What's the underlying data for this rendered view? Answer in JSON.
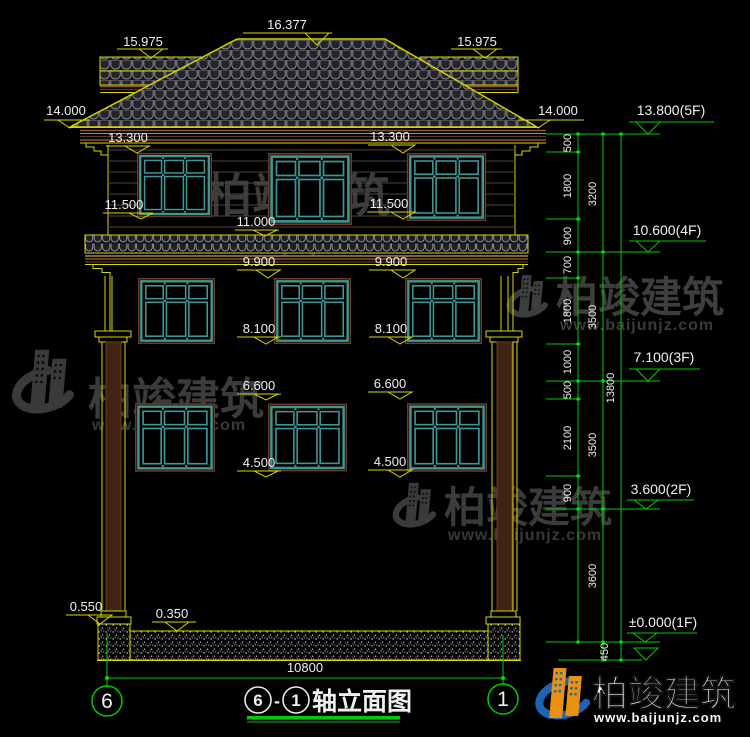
{
  "watermark": {
    "brand": "柏竣建筑",
    "url": "www.baijunjz.com"
  },
  "title": {
    "axis_from": "6",
    "dash": "-",
    "axis_to": "1",
    "name": "轴立面图"
  },
  "axis_bubbles": {
    "left": "6",
    "right": "1"
  },
  "bottom_dim": {
    "total_width": "10800"
  },
  "levels": {
    "ridge": "16.377",
    "wing_left": "15.975",
    "wing_right": "15.975",
    "eave_left": "14.000",
    "eave_right": "14.000",
    "attic_win_top_left": "13.300",
    "attic_win_top_right": "13.300",
    "attic_win_bottom_left": "11.500",
    "attic_win_bottom_right": "11.500",
    "mid_eave": "11.000",
    "f3_win_top_left": "9.900",
    "f3_win_top_right": "9.900",
    "f3_win_bottom_left": "8.100",
    "f3_win_bottom_right": "8.100",
    "f2_win_top_left": "6.600",
    "f2_win_top_right": "6.600",
    "f2_win_bottom_left": "4.500",
    "f2_win_bottom_right": "4.500",
    "plinth": "0.550",
    "slab": "0.350"
  },
  "floor_markers": {
    "f5": "13.800(5F)",
    "f4": "10.600(4F)",
    "f3": "7.100(3F)",
    "f2": "3.600(2F)",
    "f1": "±0.000(1F)"
  },
  "dim_chain": {
    "segments": [
      "500",
      "1800",
      "900",
      "700",
      "1800",
      "1000",
      "500",
      "2100",
      "900"
    ],
    "floors": [
      "3200",
      "3500",
      "3500",
      "3600"
    ],
    "total": "13800",
    "foundation": "450"
  },
  "colors": {
    "cad_yellow": "#d6d600",
    "dim_green": "#00cc00",
    "window_teal": "#3f9793",
    "text_white": "#f0f0f0",
    "brand_blue": "#1e64b4",
    "brand_orange": "#e8920f"
  }
}
